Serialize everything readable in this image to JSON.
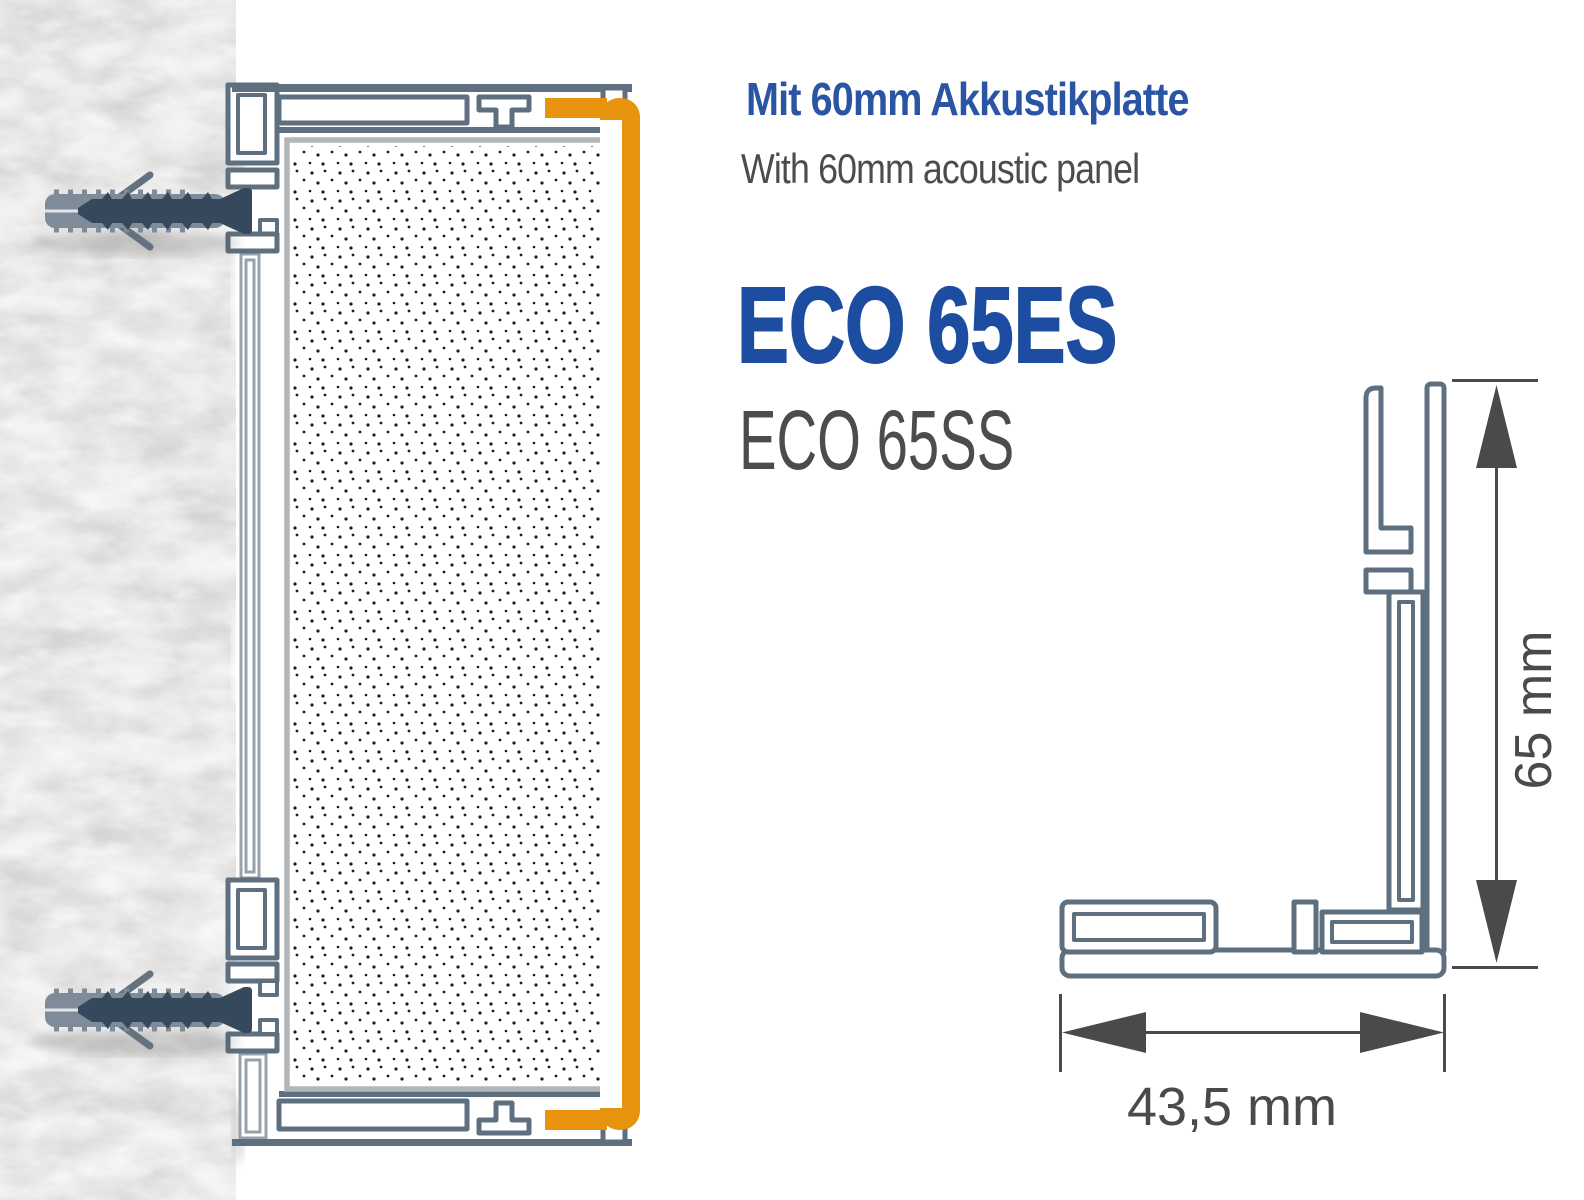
{
  "header": {
    "title_de": "Mit 60mm Akkustikplatte",
    "subtitle_en": "With 60mm acoustic panel"
  },
  "product": {
    "name_primary": "ECO 65ES",
    "name_secondary": "ECO 65SS"
  },
  "cross_section": {
    "height_label": "65 mm",
    "width_label": "43,5 mm"
  },
  "icons": {
    "screw_anchor": "screw-anchor-icon",
    "dimension_arrow_vertical": "arrow-vertical-icon",
    "dimension_arrow_horizontal": "arrow-horizontal-icon"
  },
  "colors": {
    "accent_orange": "#E8930D",
    "profile_slate": "#5E6F7F",
    "rail_gray": "#97A1AB",
    "panel_border": "#B2B7BC",
    "heading_blue": "#2A54A4",
    "product_blue": "#1D4DA0",
    "text_gray": "#4C4C4C",
    "dim_gray": "#4A4A4A",
    "screw_dark": "#36495C",
    "anchor_gray": "#7E8B99",
    "wing_gray": "#64717E",
    "wall_base": "#EFEEEC",
    "dot_color": "#1C1C1C"
  }
}
